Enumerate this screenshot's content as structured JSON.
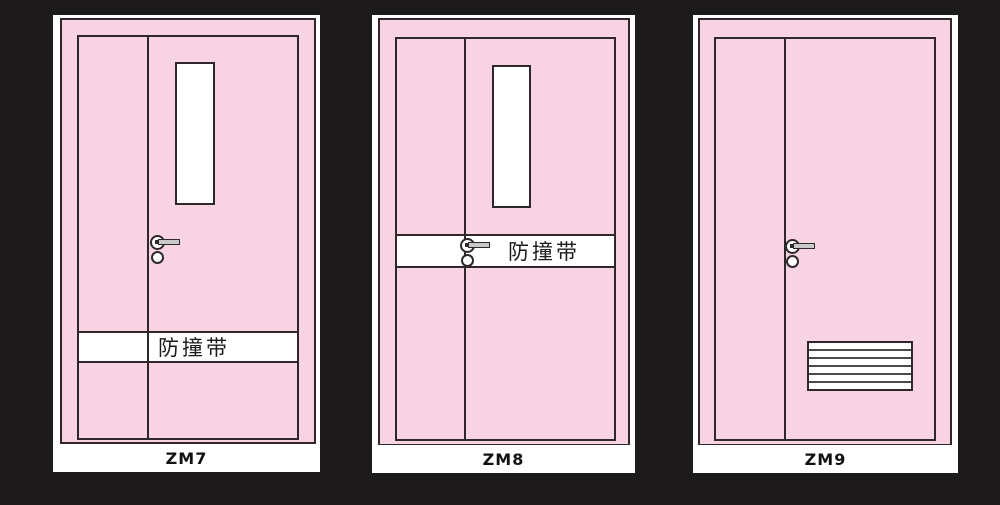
{
  "colors": {
    "background": "#1d1a1c",
    "door_pink": "#f8d3e3",
    "line": "#2e282b",
    "panel_white": "#ffffff",
    "handle_gray": "#c9c9c9"
  },
  "panels": [
    {
      "code": "ZM7",
      "band_text": "防撞带",
      "features": [
        "vision-window",
        "lever-handle",
        "impact-band-low"
      ]
    },
    {
      "code": "ZM8",
      "band_text": "防撞带",
      "features": [
        "vision-window",
        "lever-handle",
        "impact-band-at-handle"
      ]
    },
    {
      "code": "ZM9",
      "features": [
        "lever-handle",
        "louver-vent"
      ]
    }
  ]
}
